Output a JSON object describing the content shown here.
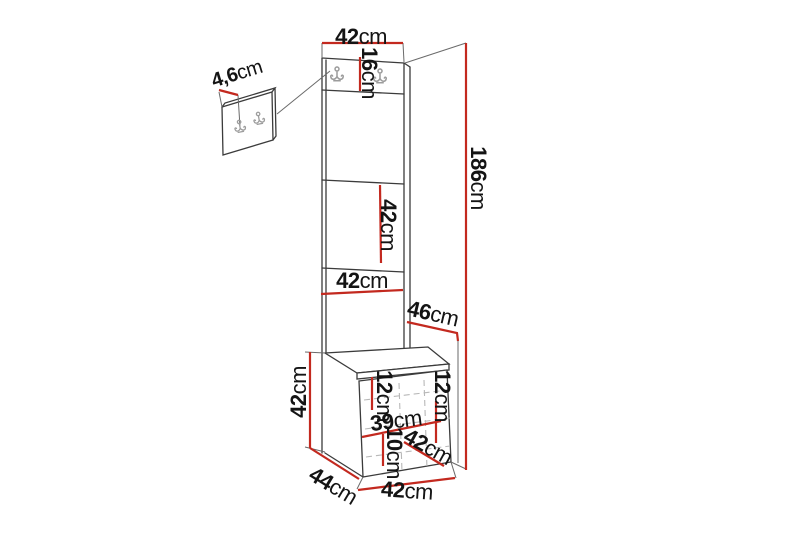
{
  "colors": {
    "dimension_line": "#c3291f",
    "outline": "#3b3b3b",
    "extension_line": "#6a6a6a",
    "dashed_line": "#b8b8b8",
    "hook": "#9c9c9c",
    "label_text": "#141414",
    "background": "#ffffff"
  },
  "dimensions": {
    "panel_top_width": {
      "value": "42",
      "unit": "cm"
    },
    "hook_rail_height": {
      "value": "16",
      "unit": "cm"
    },
    "total_height": {
      "value": "186",
      "unit": "cm"
    },
    "panel_section_height": {
      "value": "42",
      "unit": "cm"
    },
    "panel_lower_width": {
      "value": "42",
      "unit": "cm"
    },
    "top_depth": {
      "value": "46",
      "unit": "cm"
    },
    "wall_panel_hook_width": {
      "value": "4,6",
      "unit": "cm"
    },
    "bench_height": {
      "value": "42",
      "unit": "cm"
    },
    "bench_upper_left_height": {
      "value": "12",
      "unit": "cm"
    },
    "bench_upper_right_height": {
      "value": "12",
      "unit": "cm"
    },
    "bench_inner_width": {
      "value": "39",
      "unit": "cm"
    },
    "bench_lower_height": {
      "value": "10",
      "unit": "cm"
    },
    "bench_seat_depth": {
      "value": "42",
      "unit": "cm"
    },
    "bench_depth": {
      "value": "44",
      "unit": "cm"
    },
    "bench_width": {
      "value": "42",
      "unit": "cm"
    }
  }
}
